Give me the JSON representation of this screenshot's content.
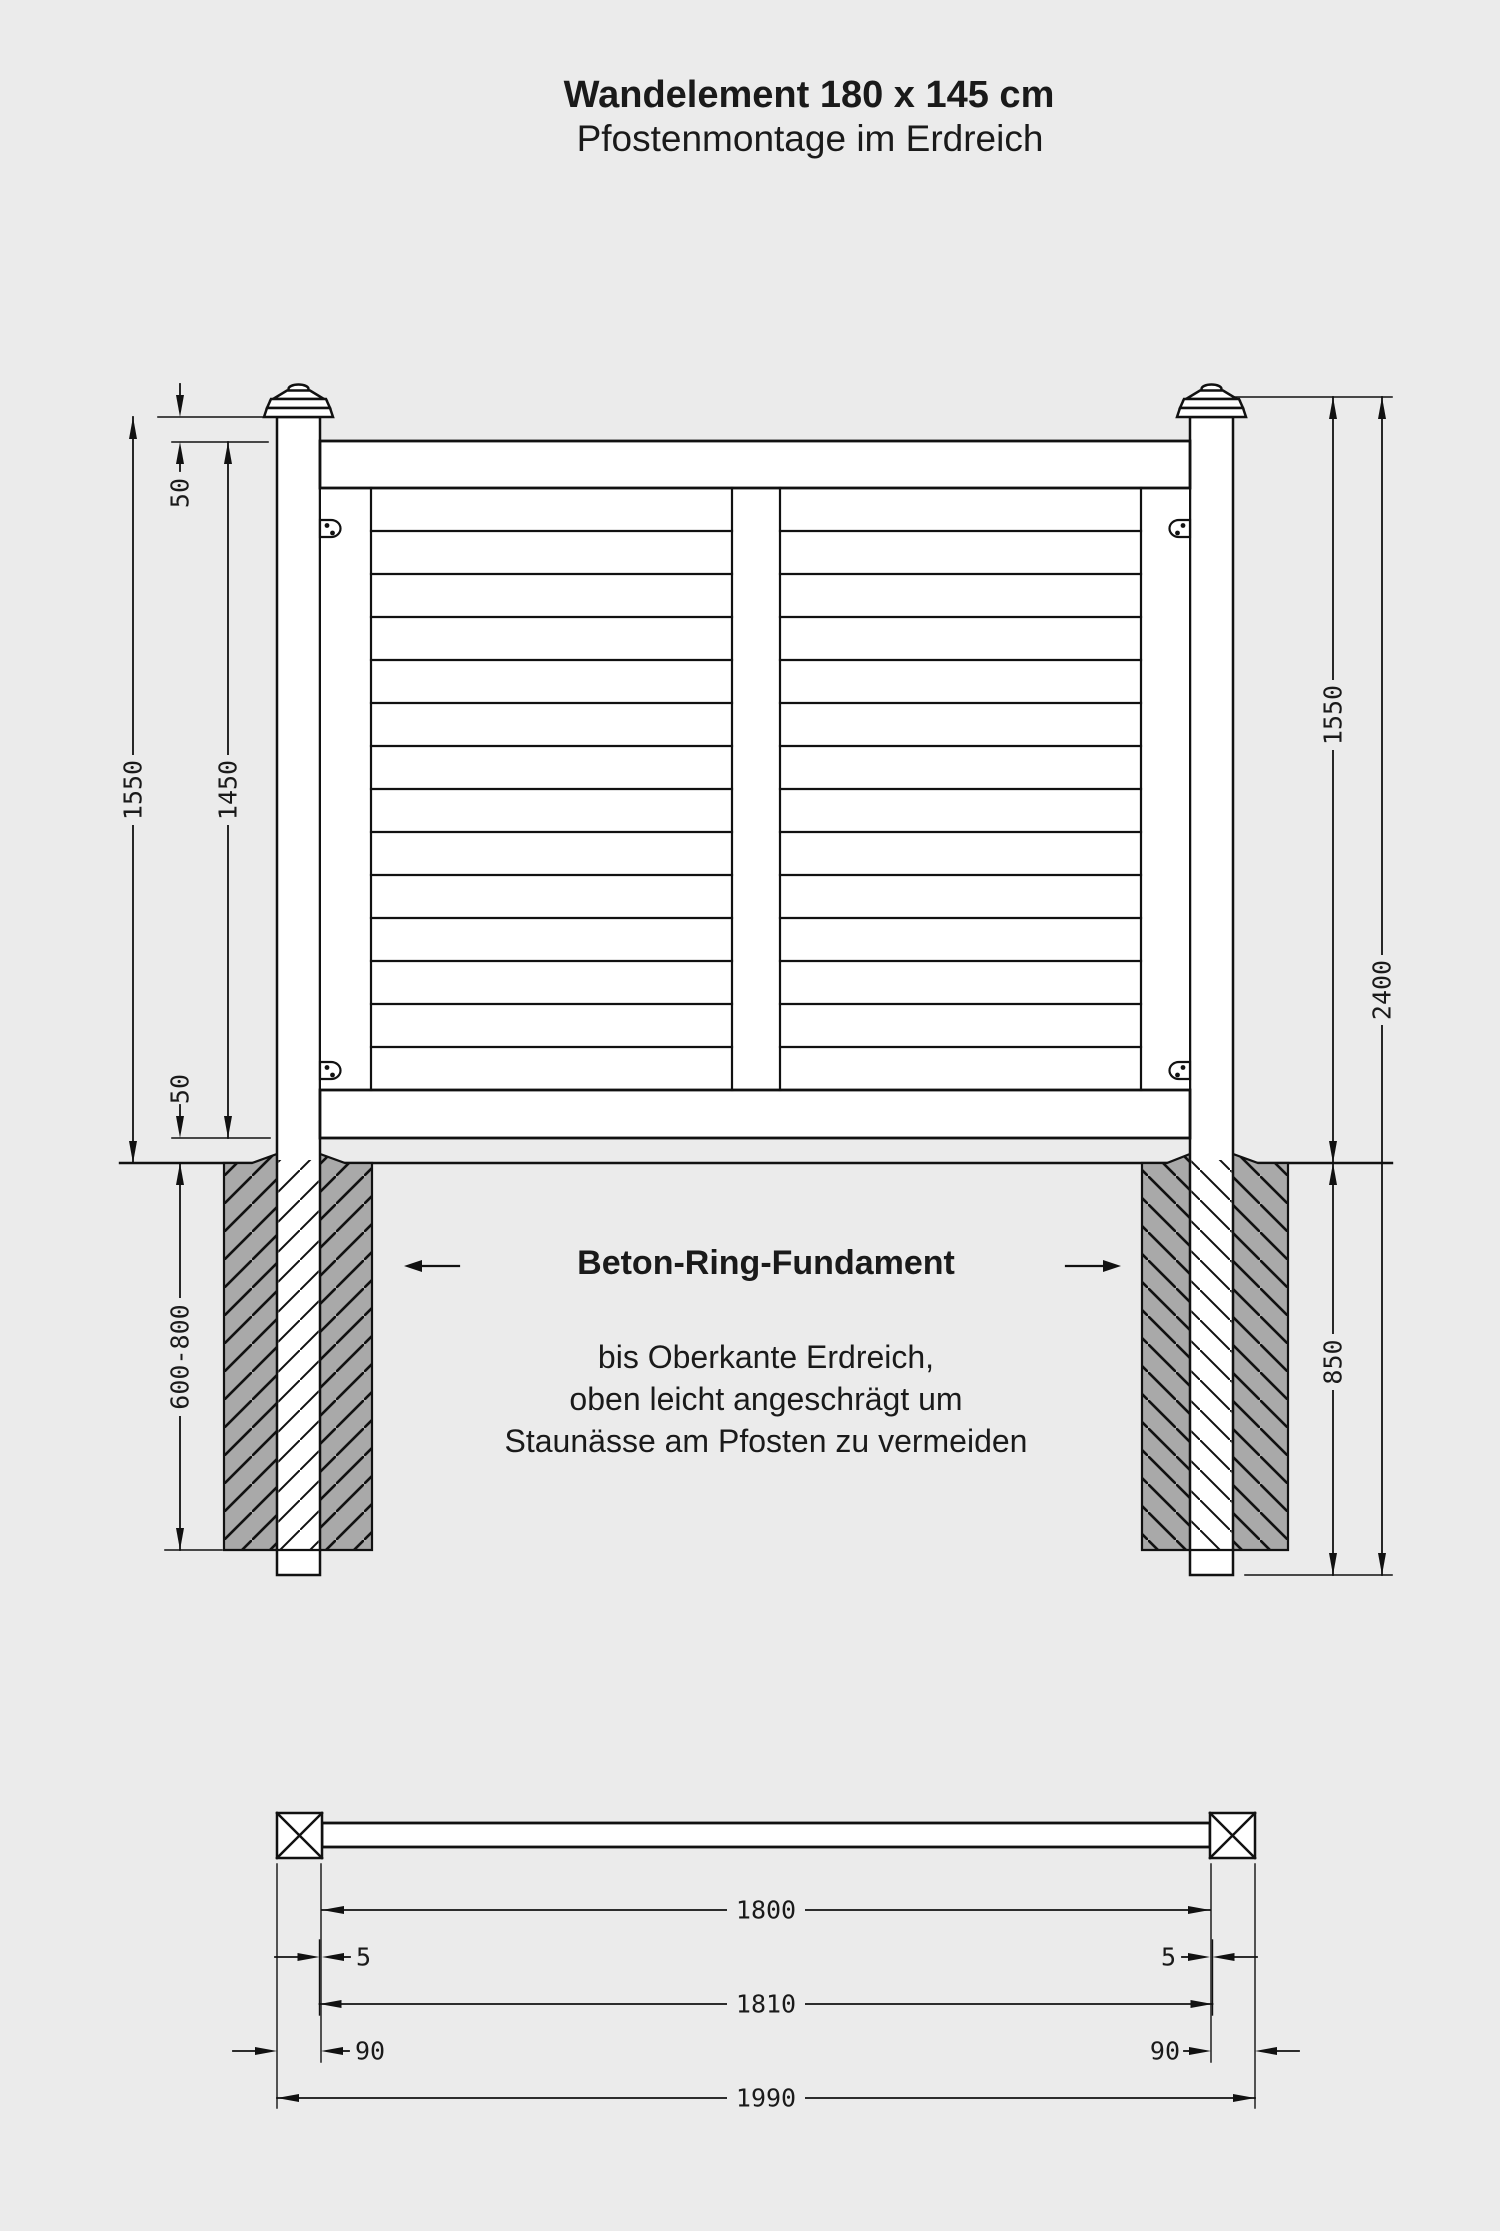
{
  "header": {
    "title": "Wandelement 180 x 145 cm",
    "subtitle": "Pfostenmontage im Erdreich"
  },
  "elevation_dims": {
    "offset_top": "50",
    "element_height": "1450",
    "offset_bottom": "50",
    "above_ground_left": "1550",
    "foundation_depth": "600-800",
    "above_ground_right": "1550",
    "post_buried": "850",
    "post_total": "2400"
  },
  "foundation_note": {
    "heading": "Beton-Ring-Fundament",
    "line1": "bis Oberkante Erdreich,",
    "line2": "oben leicht angeschrägt um",
    "line3": "Staunässe am Pfosten zu vermeiden"
  },
  "plan_dims": {
    "clear_span": "1800",
    "tenon_left": "5",
    "tenon_right": "5",
    "element_length": "1810",
    "post_width_left": "90",
    "post_width_right": "90",
    "overall_length": "1990"
  },
  "colors": {
    "background": "#ebebeb",
    "line": "#111111",
    "foundation_gray": "#a9a9a9",
    "fill_white": "#ffffff"
  }
}
